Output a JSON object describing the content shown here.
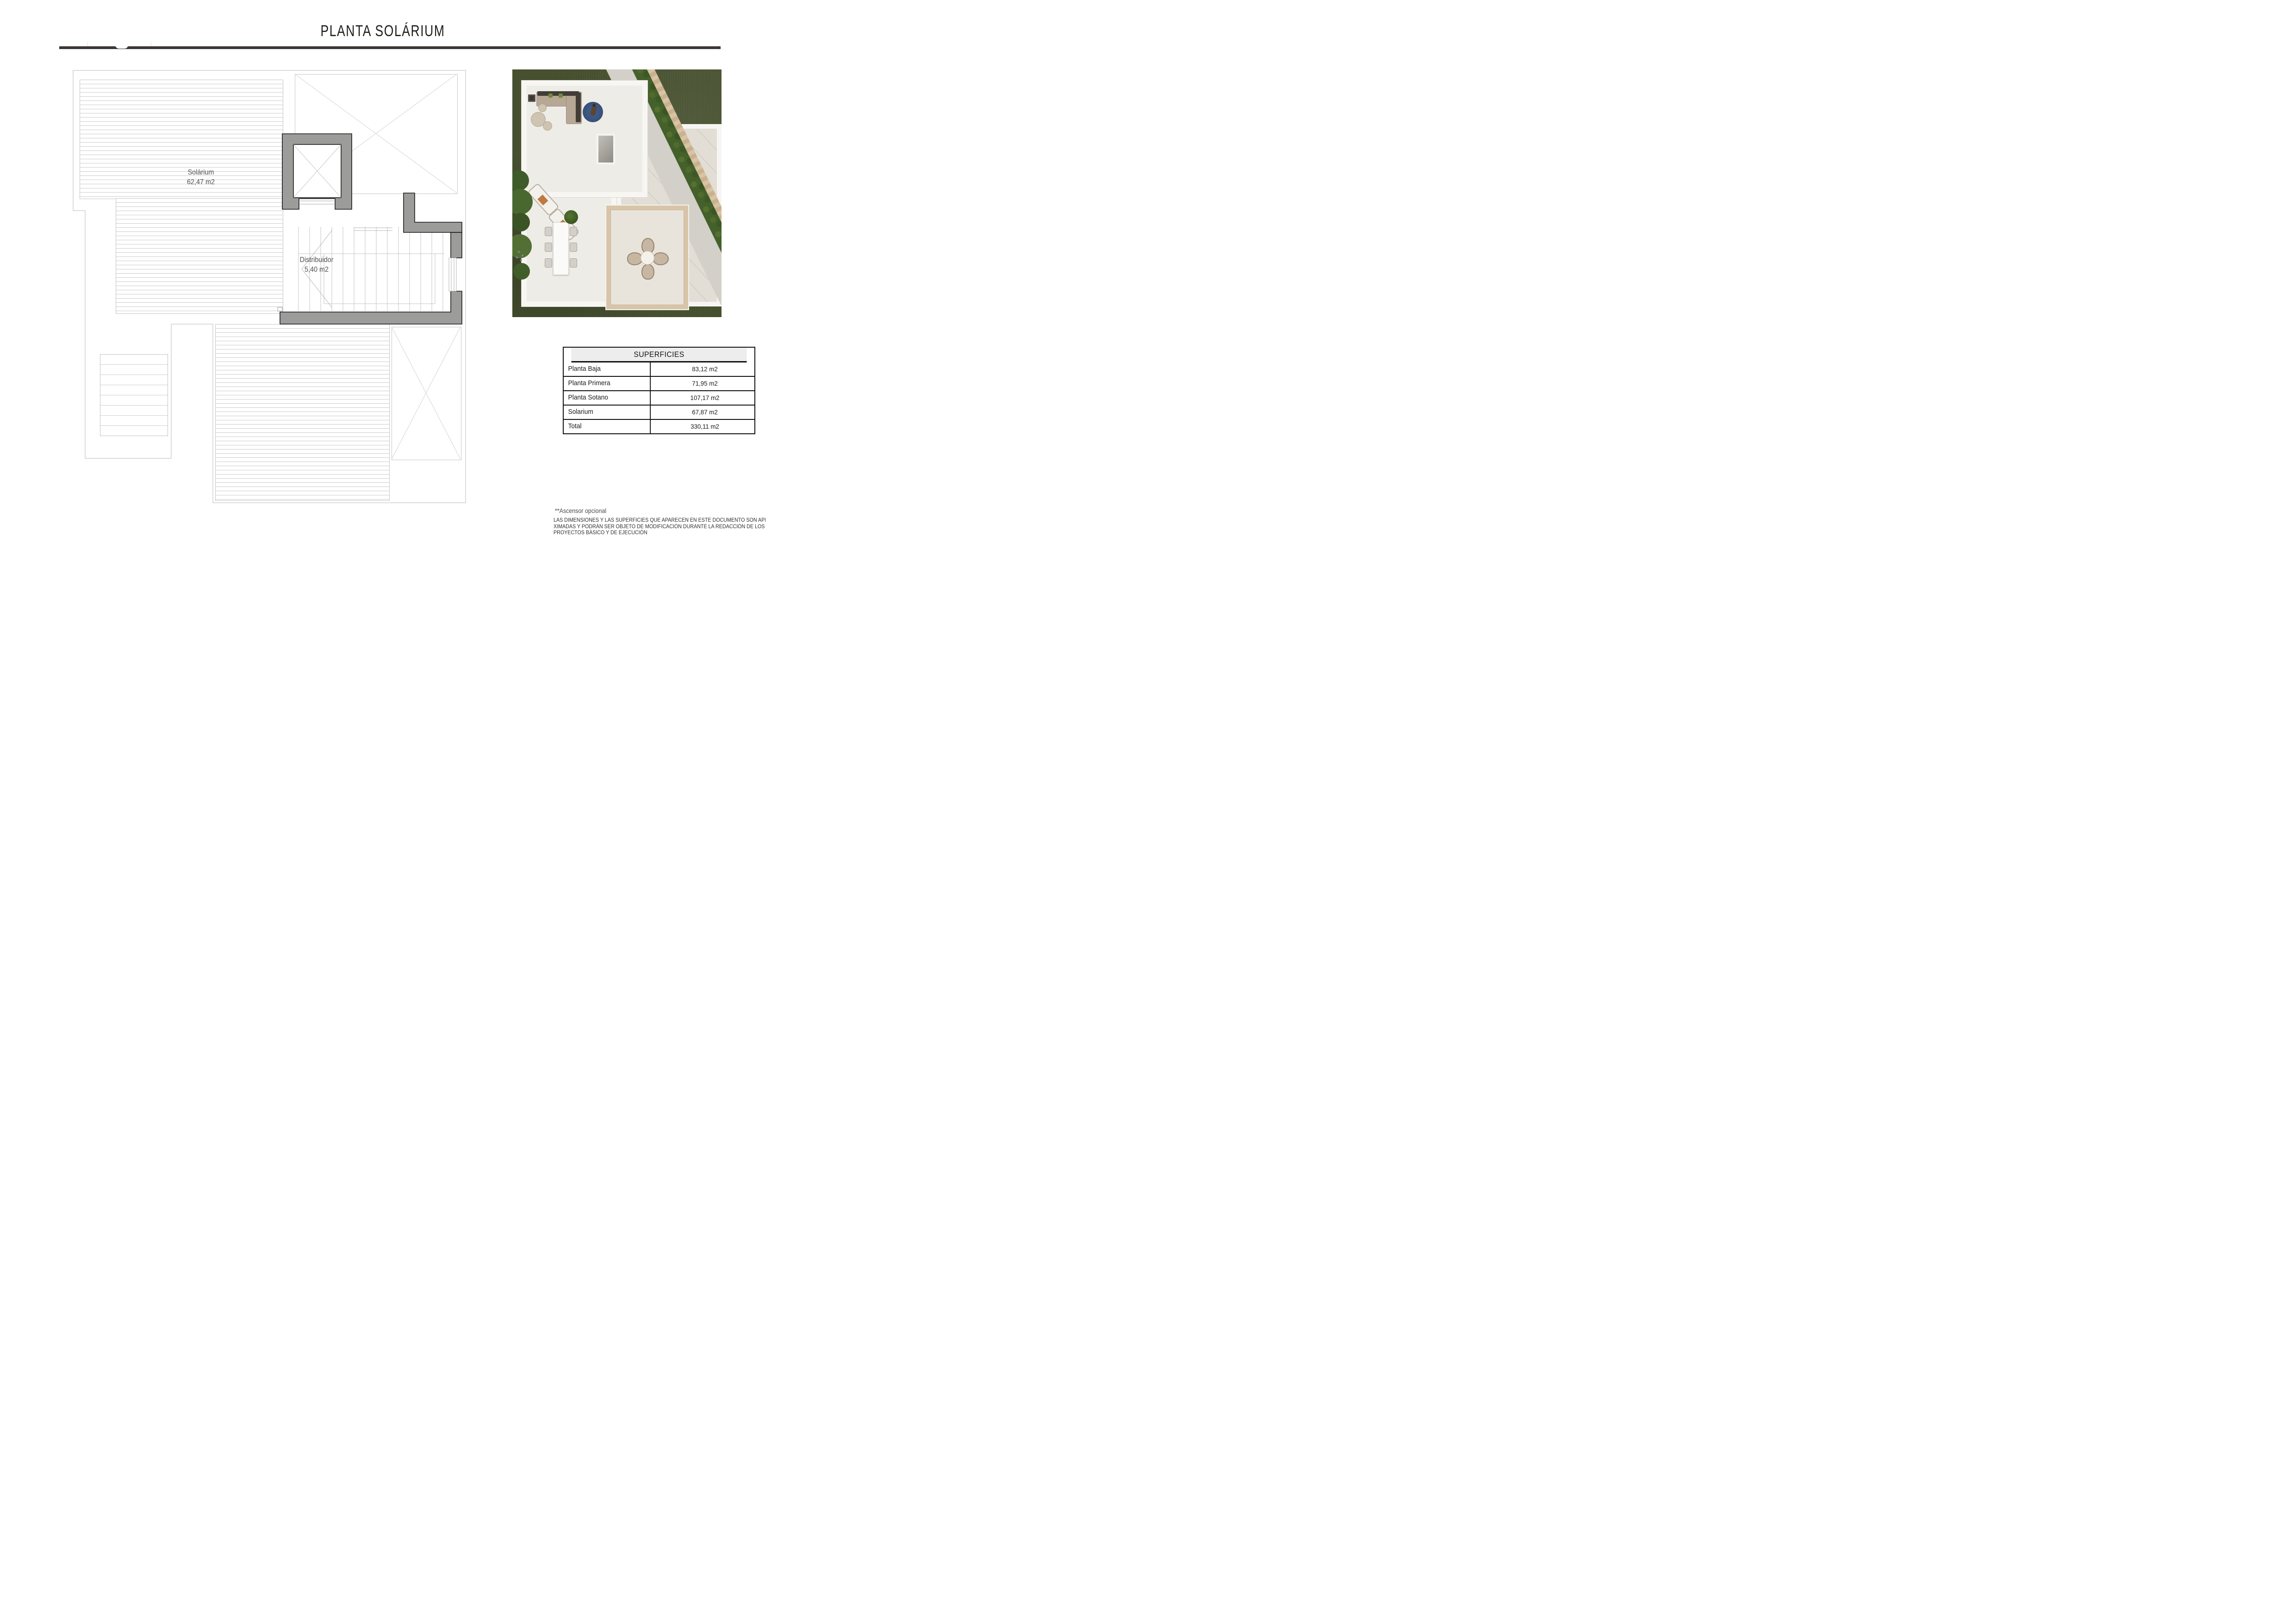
{
  "header": {
    "title": "PLANTA SOLÁRIUM"
  },
  "floor_plan": {
    "solarium": {
      "name": "Solárium",
      "area": "62,47 m2"
    },
    "distribuidor": {
      "name": "Distribuidor",
      "area": "5,40 m2"
    }
  },
  "surfaces_table": {
    "title": "SUPERFICIES",
    "rows": [
      {
        "label": "Planta Baja",
        "value": "83,12 m2"
      },
      {
        "label": "Planta Primera",
        "value": "71,95 m2"
      },
      {
        "label": "Planta Sotano",
        "value": "107,17 m2"
      },
      {
        "label": "Solarium",
        "value": "67,87 m2"
      },
      {
        "label": "Total",
        "value": "330,11 m2"
      }
    ]
  },
  "footnotes": {
    "elevator_note": "**Ascensor opcional",
    "disclaimer_lines": [
      "LAS DIMENSIONES Y LAS SUPERFICIES QUE APARECEN EN ESTE DOCUMENTO SON APRO-",
      "XIMADAS Y PODRÁN SER OBJETO DE MODIFICACIÓN DURANTE LA REDACCIÓN DE LOS",
      "PROYECTOS BÁSICO Y DE EJECUCIÓN"
    ]
  },
  "colors": {
    "accent_bar": "#3e3632",
    "wall_gray": "#9c9c9b",
    "plan_line": "#c6c6c6",
    "grass_green": "#454f2e",
    "hedge_green": "#44602b",
    "stone_wall_tan": "#d4bf9f",
    "table_header_bg": "#ededed"
  }
}
